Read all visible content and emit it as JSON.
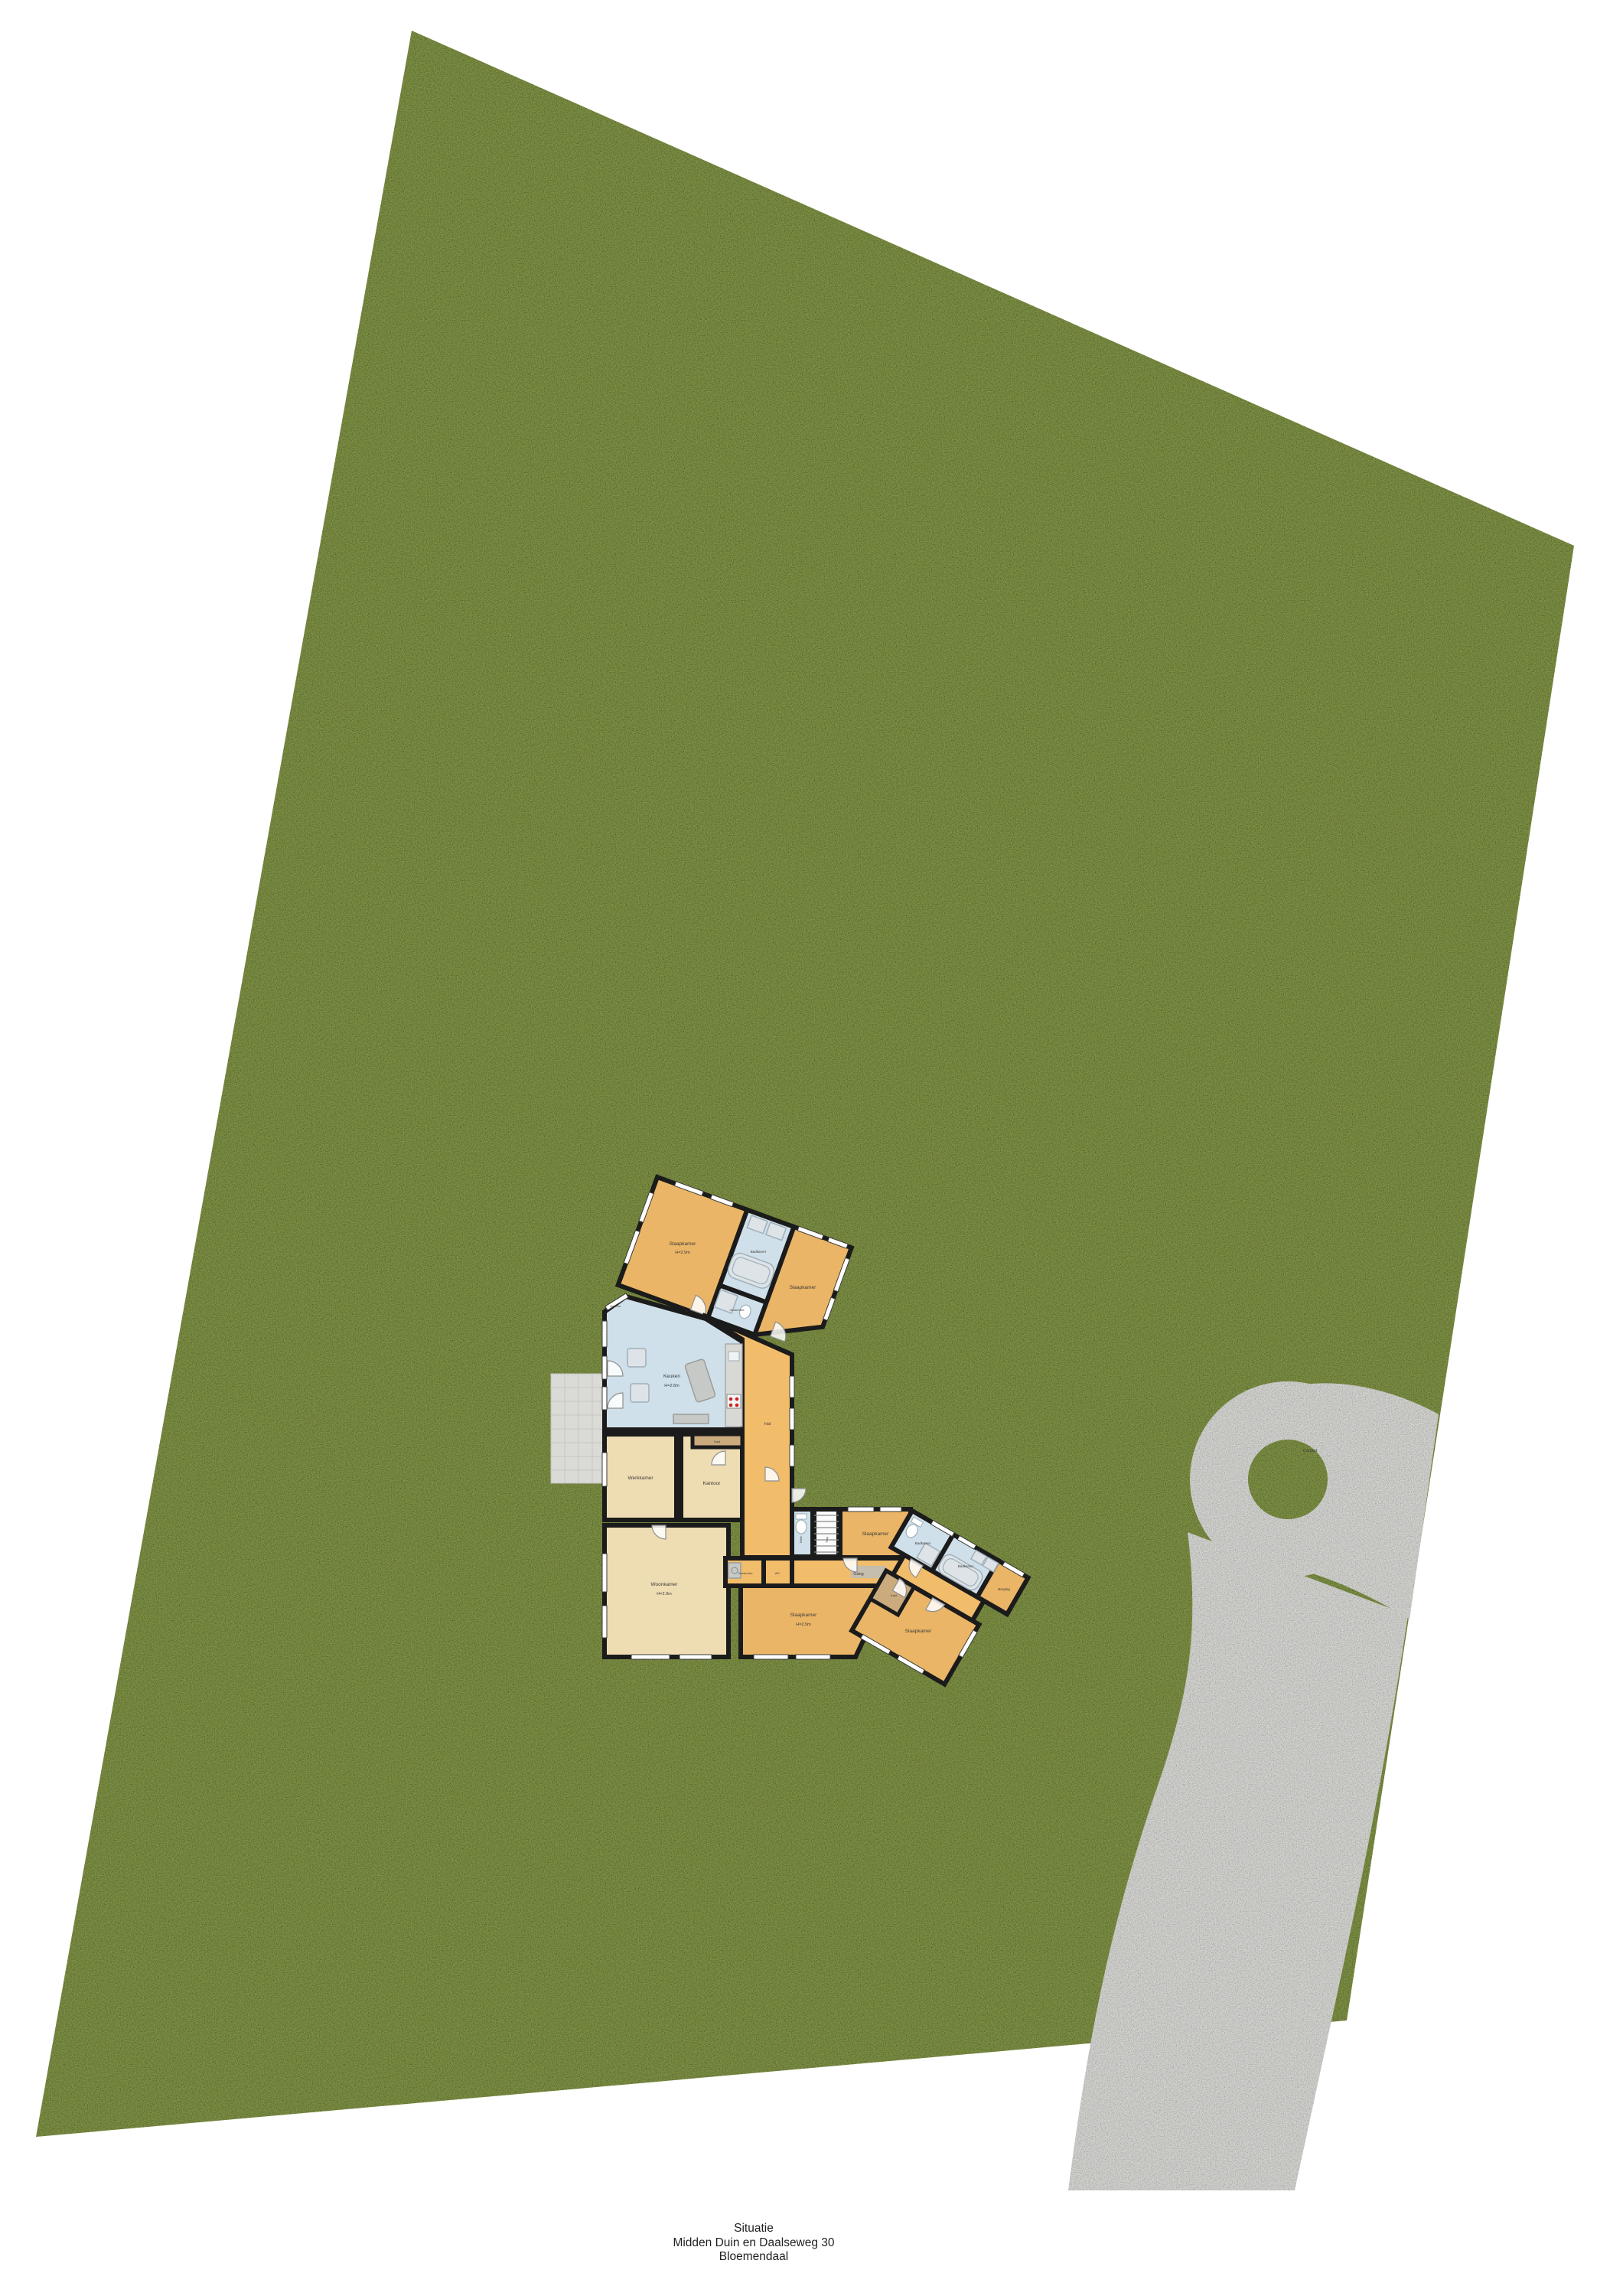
{
  "caption": {
    "line1": "Situatie",
    "line2": "Midden Duin en Daalseweg 30",
    "line3": "Bloemendaal"
  },
  "site": {
    "background": "#ffffff",
    "grass_color": "#7e9144",
    "driveway_color": "#d3d3d0",
    "terrace_color": "#dadad7",
    "wall_color": "#1b1b1b",
    "room_orange": "#eab566",
    "room_beige": "#eedcb2",
    "room_blue": "#cfe0ea",
    "corridor_orange": "#f2bd6b"
  },
  "labels": {
    "slaapkamer_nw": {
      "name": "Slaapkamer",
      "dim": "H=2.9m"
    },
    "badkamer_noord": {
      "name": "Badkamer"
    },
    "garderobe_noord": {
      "name": "Garderobe"
    },
    "slaapkamer_no": {
      "name": "Slaapkamer"
    },
    "keuken": {
      "name": "Keuken",
      "dim": "H=2.8m",
      "wall_dim": "H=2.6m"
    },
    "hal": {
      "name": "Hal"
    },
    "werkkamer": {
      "name": "Werkkamer"
    },
    "kantoor": {
      "name": "Kantoor"
    },
    "kast_noord": {
      "name": "Kast"
    },
    "woonkamer": {
      "name": "Woonkamer",
      "dim": "H=2.9m"
    },
    "garderobe_zuid": {
      "name": "Garderobe"
    },
    "wc": {
      "name": "WC"
    },
    "toilet": {
      "name": "Toilet"
    },
    "trap": {
      "name": "Trap"
    },
    "gang": {
      "name": "Gang"
    },
    "kast_zuid": {
      "name": "Kast"
    },
    "slaapkamer_midden": {
      "name": "Slaapkamer",
      "dim": "H=2.9m"
    },
    "slaapkamer_oost": {
      "name": "Slaapkamer"
    },
    "badkamer_oost1": {
      "name": "Badkamer"
    },
    "badkamer_oost2": {
      "name": "Badkamer"
    },
    "berging": {
      "name": "Berging"
    },
    "slaapkamer_zo": {
      "name": "Slaapkamer"
    },
    "carport": {
      "name": "Carport"
    }
  }
}
